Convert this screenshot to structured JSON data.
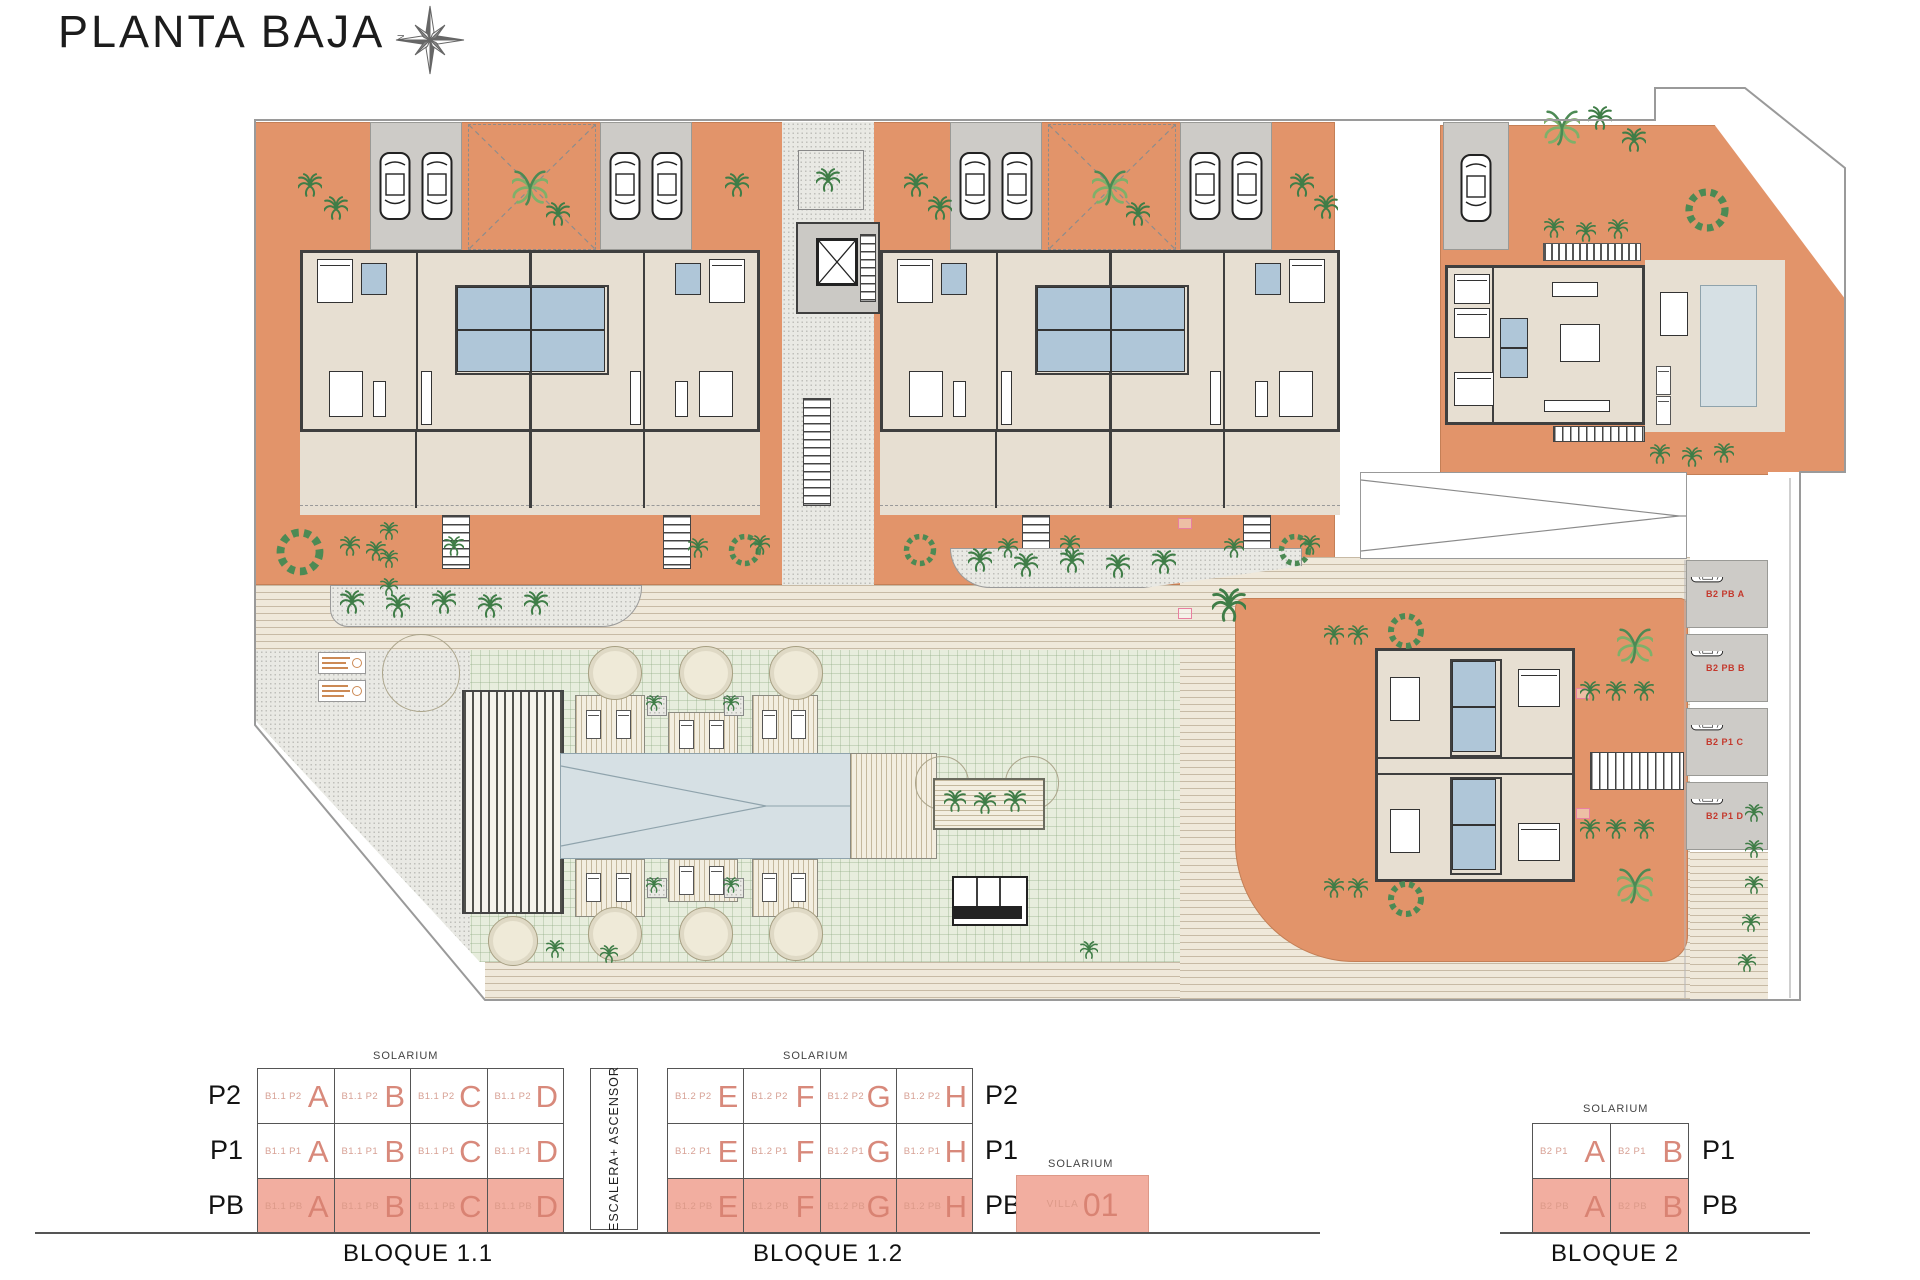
{
  "header": {
    "title": "PLANTA BAJA",
    "compass_letter": "N"
  },
  "plan": {
    "parking_labels": [
      "B2 PB A",
      "B2 PB B",
      "B2 P1 C",
      "B2 P1 D"
    ]
  },
  "legend": {
    "solarium_label": "SOLARIUM",
    "escalera": {
      "label": "ESCALERA+ ASCENSOR"
    },
    "bloque11": {
      "title": "BLOQUE 1.1",
      "rows": [
        {
          "floor": "P2",
          "cells": [
            {
              "code": "B1.1 P2",
              "letter": "A"
            },
            {
              "code": "B1.1 P2",
              "letter": "B"
            },
            {
              "code": "B1.1 P2",
              "letter": "C"
            },
            {
              "code": "B1.1 P2",
              "letter": "D"
            }
          ]
        },
        {
          "floor": "P1",
          "cells": [
            {
              "code": "B1.1 P1",
              "letter": "A"
            },
            {
              "code": "B1.1 P1",
              "letter": "B"
            },
            {
              "code": "B1.1 P1",
              "letter": "C"
            },
            {
              "code": "B1.1 P1",
              "letter": "D"
            }
          ]
        },
        {
          "floor": "PB",
          "cells": [
            {
              "code": "B1.1 PB",
              "letter": "A"
            },
            {
              "code": "B1.1 PB",
              "letter": "B"
            },
            {
              "code": "B1.1 PB",
              "letter": "C"
            },
            {
              "code": "B1.1 PB",
              "letter": "D"
            }
          ]
        }
      ]
    },
    "bloque12": {
      "title": "BLOQUE 1.2",
      "rows": [
        {
          "floor": "P2",
          "cells": [
            {
              "code": "B1.2 P2",
              "letter": "E"
            },
            {
              "code": "B1.2 P2",
              "letter": "F"
            },
            {
              "code": "B1.2 P2",
              "letter": "G"
            },
            {
              "code": "B1.2 P2",
              "letter": "H"
            }
          ]
        },
        {
          "floor": "P1",
          "cells": [
            {
              "code": "B1.2 P1",
              "letter": "E"
            },
            {
              "code": "B1.2 P1",
              "letter": "F"
            },
            {
              "code": "B1.2 P1",
              "letter": "G"
            },
            {
              "code": "B1.2 P1",
              "letter": "H"
            }
          ]
        },
        {
          "floor": "PB",
          "cells": [
            {
              "code": "B1.2 PB",
              "letter": "E"
            },
            {
              "code": "B1.2 PB",
              "letter": "F"
            },
            {
              "code": "B1.2 PB",
              "letter": "G"
            },
            {
              "code": "B1.2 PB",
              "letter": "H"
            }
          ]
        }
      ]
    },
    "villa": {
      "solarium": "SOLARIUM",
      "code": "VILLA",
      "number": "01"
    },
    "bloque2": {
      "title": "BLOQUE 2",
      "rows": [
        {
          "floor": "P1",
          "cells": [
            {
              "code": "B2 P1",
              "letter": "A"
            },
            {
              "code": "B2 P1",
              "letter": "B"
            }
          ]
        },
        {
          "floor": "PB",
          "cells": [
            {
              "code": "B2 PB",
              "letter": "A"
            },
            {
              "code": "B2 PB",
              "letter": "B"
            }
          ]
        }
      ]
    }
  },
  "colors": {
    "garden": "#E2946A",
    "interior": "#E7DFD2",
    "wall": "#3F3F3F",
    "bath_blue": "#AFC6D8",
    "lawn": "#E7EDDD",
    "pool": "#D6E0E4",
    "legend_pink": "#F2AEA0",
    "unit_letter": "#D8897B",
    "parking_label_red": "#C4382C"
  }
}
